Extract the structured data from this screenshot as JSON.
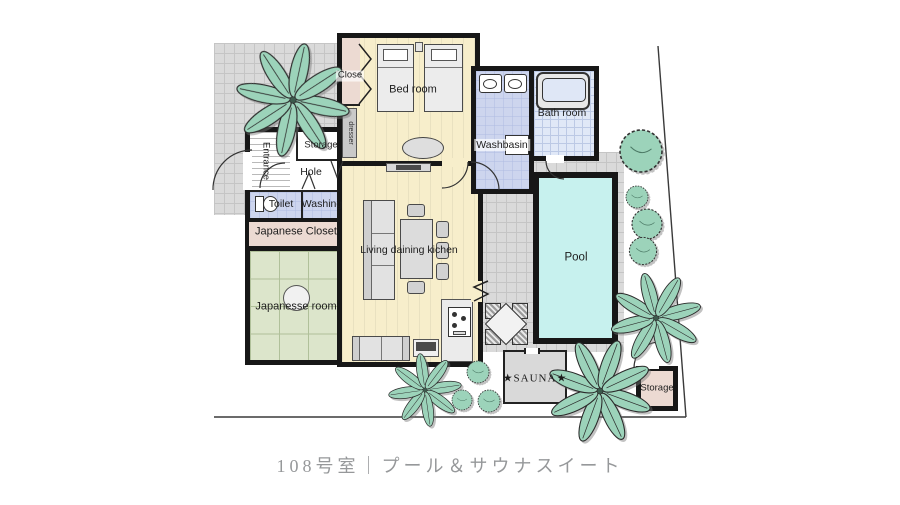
{
  "caption": "108号室｜プール＆サウナスイート",
  "labels": {
    "close": "Close",
    "bedroom": "Bed room",
    "dresser": "dresser",
    "washbasin": "Washbasin",
    "bathroom": "Bath room",
    "entrance": "Entrance",
    "storage_inner": "Storage",
    "hole": "Hole",
    "toilet": "Toilet",
    "washing": "Washing",
    "japanese_closet": "Japanese Closet",
    "japanese_room": "Japanesse room",
    "living": "Living daining kichen",
    "pool": "Pool",
    "sauna": "★SAUNA★",
    "storage_outdoor": "Storage"
  },
  "colors": {
    "wall": "#171717",
    "wood_floor": "#f7eecb",
    "water_pool": "#c7f1ee",
    "tatami": "#dce5cb",
    "closet_pink": "#ecdad2",
    "wet_room_lavender": "#cdd5ee",
    "bath_tile": "#e0e8f7",
    "deck_tile": "#dadada",
    "plant_green": "#9cd3ba",
    "caption_gray": "#96989a"
  }
}
